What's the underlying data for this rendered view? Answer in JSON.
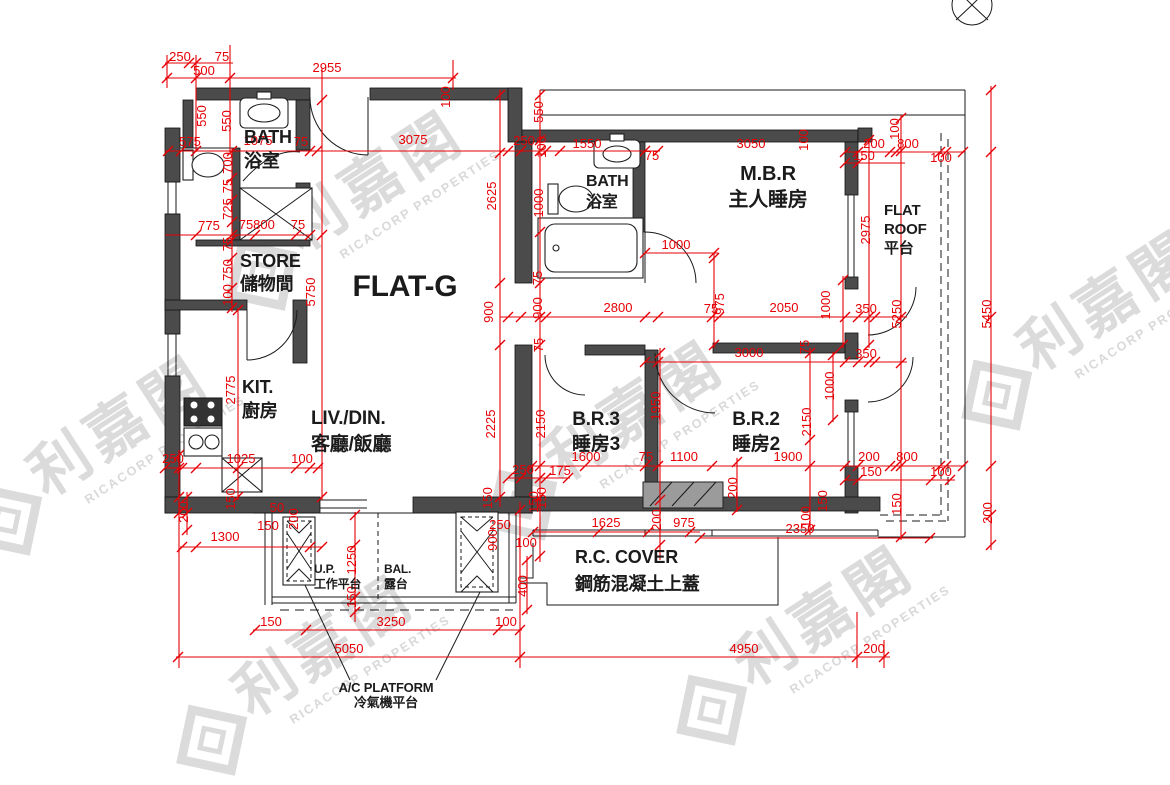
{
  "title": "FLAT-G",
  "watermark": {
    "cjk": "利嘉閣",
    "latin": "RICACORP PROPERTIES"
  },
  "north_icon": "north-arrow",
  "rooms": [
    {
      "id": "flat-g",
      "lines": [
        "FLAT-G"
      ],
      "x": 405,
      "y": 296,
      "s": 30,
      "lh": 0,
      "a": "middle"
    },
    {
      "id": "bath-1",
      "lines": [
        "BATH",
        "浴室"
      ],
      "x": 244,
      "y": 143,
      "s": 18,
      "lh": 24,
      "a": "start"
    },
    {
      "id": "store",
      "lines": [
        "STORE",
        "儲物間"
      ],
      "x": 240,
      "y": 267,
      "s": 18,
      "lh": 23,
      "a": "start"
    },
    {
      "id": "kitchen",
      "lines": [
        "KIT.",
        "廚房"
      ],
      "x": 242,
      "y": 393,
      "s": 18,
      "lh": 24,
      "a": "start"
    },
    {
      "id": "living-dining",
      "lines": [
        "LIV./DIN.",
        "客廳/飯廳"
      ],
      "x": 311,
      "y": 424,
      "s": 19,
      "lh": 26,
      "a": "start"
    },
    {
      "id": "bath-2",
      "lines": [
        "BATH",
        "浴室"
      ],
      "x": 586,
      "y": 186,
      "s": 16,
      "lh": 21,
      "a": "start"
    },
    {
      "id": "master-bedroom",
      "lines": [
        "M.B.R",
        "主人睡房"
      ],
      "x": 768,
      "y": 180,
      "s": 20,
      "lh": 26,
      "a": "middle"
    },
    {
      "id": "flat-roof",
      "lines": [
        "FLAT",
        "ROOF",
        "平台"
      ],
      "x": 884,
      "y": 215,
      "s": 15,
      "lh": 19,
      "a": "start"
    },
    {
      "id": "bedroom-3",
      "lines": [
        "B.R.3",
        "睡房3"
      ],
      "x": 596,
      "y": 425,
      "s": 19,
      "lh": 25,
      "a": "middle"
    },
    {
      "id": "bedroom-2",
      "lines": [
        "B.R.2",
        "睡房2"
      ],
      "x": 756,
      "y": 425,
      "s": 19,
      "lh": 25,
      "a": "middle"
    },
    {
      "id": "utility-platform",
      "lines": [
        "U.P.",
        "工作平台"
      ],
      "x": 314,
      "y": 573,
      "s": 12,
      "lh": 15,
      "a": "start"
    },
    {
      "id": "balcony",
      "lines": [
        "BAL.",
        "露台"
      ],
      "x": 384,
      "y": 573,
      "s": 12,
      "lh": 15,
      "a": "start"
    },
    {
      "id": "rc-cover",
      "lines": [
        "R.C. COVER",
        "鋼筋混凝土上蓋"
      ],
      "x": 575,
      "y": 563,
      "s": 18,
      "lh": 27,
      "a": "start"
    },
    {
      "id": "ac-platform",
      "lines": [
        "A/C PLATFORM",
        "冷氣機平台"
      ],
      "x": 386,
      "y": 692,
      "s": 13,
      "lh": 15,
      "a": "middle"
    }
  ],
  "dimensions": [
    [
      "250",
      180,
      61,
      0
    ],
    [
      "75",
      222,
      61,
      0
    ],
    [
      "500",
      204,
      75,
      0
    ],
    [
      "2955",
      327,
      72,
      0
    ],
    [
      "100",
      450,
      97,
      1
    ],
    [
      "550",
      206,
      116,
      1
    ],
    [
      "550",
      231,
      121,
      1
    ],
    [
      "575",
      190,
      146,
      0
    ],
    [
      "1075",
      258,
      145,
      0
    ],
    [
      "75",
      301,
      146,
      0
    ],
    [
      "3075",
      413,
      144,
      0
    ],
    [
      "250",
      524,
      145,
      0
    ],
    [
      "100",
      546,
      147,
      1
    ],
    [
      "550",
      543,
      112,
      1
    ],
    [
      "1550",
      587,
      148,
      0
    ],
    [
      "75",
      652,
      160,
      0
    ],
    [
      "3050",
      751,
      148,
      0
    ],
    [
      "100",
      808,
      140,
      1
    ],
    [
      "200",
      874,
      148,
      0
    ],
    [
      "800",
      908,
      148,
      0
    ],
    [
      "100",
      899,
      129,
      1
    ],
    [
      "150",
      864,
      160,
      0
    ],
    [
      "100",
      941,
      162,
      0
    ],
    [
      "700",
      232,
      163,
      1
    ],
    [
      "75",
      232,
      186,
      1
    ],
    [
      "725",
      232,
      209,
      1
    ],
    [
      "775",
      209,
      230,
      0
    ],
    [
      "75",
      246,
      229,
      0
    ],
    [
      "800",
      264,
      229,
      0
    ],
    [
      "75",
      298,
      229,
      0
    ],
    [
      "75",
      232,
      244,
      1
    ],
    [
      "750",
      232,
      270,
      1
    ],
    [
      "100",
      232,
      295,
      1
    ],
    [
      "5750",
      315,
      292,
      1
    ],
    [
      "2625",
      496,
      196,
      1
    ],
    [
      "1000",
      543,
      203,
      1
    ],
    [
      "75",
      542,
      278,
      1
    ],
    [
      "900",
      493,
      312,
      1
    ],
    [
      "900",
      542,
      308,
      1
    ],
    [
      "75",
      543,
      345,
      1
    ],
    [
      "2225",
      495,
      424,
      1
    ],
    [
      "2150",
      545,
      424,
      1
    ],
    [
      "250",
      523,
      474,
      0
    ],
    [
      "175",
      560,
      475,
      0
    ],
    [
      "150",
      492,
      498,
      1
    ],
    [
      "150",
      546,
      498,
      1
    ],
    [
      "1000",
      676,
      249,
      0
    ],
    [
      "2975",
      870,
      230,
      1
    ],
    [
      "2800",
      618,
      312,
      0
    ],
    [
      "75",
      711,
      313,
      0
    ],
    [
      "975",
      724,
      304,
      1
    ],
    [
      "2050",
      784,
      312,
      0
    ],
    [
      "1000",
      830,
      305,
      1
    ],
    [
      "350",
      866,
      313,
      0
    ],
    [
      "5250",
      901,
      314,
      1
    ],
    [
      "5450",
      991,
      314,
      1
    ],
    [
      "3000",
      749,
      357,
      0
    ],
    [
      "350",
      866,
      358,
      0
    ],
    [
      "75",
      809,
      347,
      1
    ],
    [
      "1950",
      660,
      406,
      1
    ],
    [
      "2150",
      811,
      422,
      1
    ],
    [
      "1000",
      834,
      386,
      1
    ],
    [
      "1600",
      586,
      461,
      0
    ],
    [
      "75",
      646,
      461,
      0
    ],
    [
      "1100",
      684,
      461,
      0
    ],
    [
      "1900",
      788,
      461,
      0
    ],
    [
      "200",
      869,
      461,
      0
    ],
    [
      "800",
      907,
      461,
      0
    ],
    [
      "150",
      871,
      476,
      0
    ],
    [
      "100",
      941,
      476,
      0
    ],
    [
      "200",
      737,
      488,
      1
    ],
    [
      "2775",
      235,
      390,
      1
    ],
    [
      "250",
      173,
      463,
      0
    ],
    [
      "1025",
      241,
      463,
      0
    ],
    [
      "100",
      302,
      463,
      0
    ],
    [
      "150",
      235,
      499,
      1
    ],
    [
      "200",
      188,
      512,
      1
    ],
    [
      "1300",
      225,
      541,
      0
    ],
    [
      "150",
      268,
      530,
      0
    ],
    [
      "50",
      277,
      512,
      0
    ],
    [
      "200",
      298,
      519,
      1
    ],
    [
      "1250",
      356,
      560,
      1
    ],
    [
      "150",
      356,
      597,
      1
    ],
    [
      "250",
      500,
      529,
      0
    ],
    [
      "100",
      526,
      547,
      0
    ],
    [
      "900",
      497,
      540,
      1
    ],
    [
      "400",
      527,
      586,
      1
    ],
    [
      "150",
      538,
      502,
      1
    ],
    [
      "200",
      661,
      520,
      1
    ],
    [
      "1625",
      606,
      527,
      0
    ],
    [
      "975",
      684,
      527,
      0
    ],
    [
      "2350",
      800,
      533,
      0
    ],
    [
      "150",
      827,
      501,
      1
    ],
    [
      "100",
      810,
      517,
      1
    ],
    [
      "150",
      901,
      504,
      1
    ],
    [
      "200",
      992,
      513,
      1
    ],
    [
      "150",
      271,
      626,
      0
    ],
    [
      "3250",
      391,
      626,
      0
    ],
    [
      "100",
      506,
      626,
      0
    ],
    [
      "5050",
      349,
      653,
      0
    ],
    [
      "4950",
      744,
      653,
      0
    ],
    [
      "200",
      874,
      653,
      0
    ]
  ]
}
